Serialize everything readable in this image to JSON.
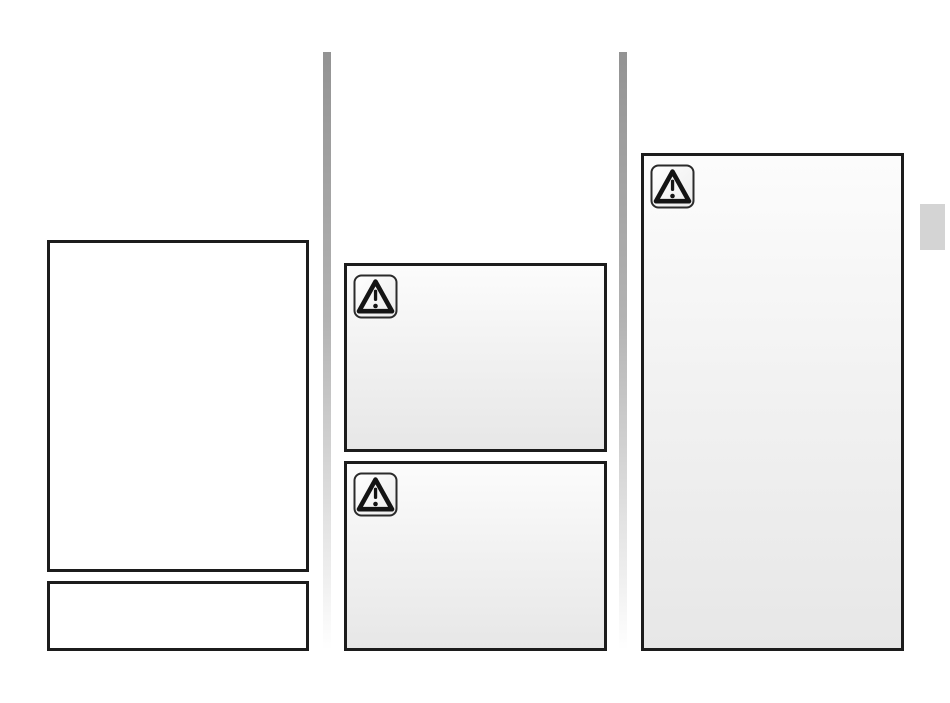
{
  "page": {
    "kind": "blank-manual-page",
    "visible_text": ""
  },
  "colors": {
    "page_bg": "#ffffff",
    "box_border": "#1c1c1c",
    "box_plain_bg": "#ffffff",
    "warn_bg_top": "#fcfcfc",
    "warn_bg_mid": "#f2f2f2",
    "warn_bg_bottom": "#e7e7e7",
    "divider_top": "#939393",
    "divider_mid": "#b3b3b3",
    "divider_low": "#e2e2e2",
    "divider_bottom": "#ffffff",
    "side_tab": "#d4d4d4",
    "icon_stroke": "#1a1a1a"
  },
  "icons": {
    "warning": "warning-triangle-icon"
  },
  "boxes": {
    "left_tall_label": "",
    "left_short_label": "",
    "mid_top_label": "",
    "mid_bottom_label": "",
    "right_tall_label": ""
  }
}
